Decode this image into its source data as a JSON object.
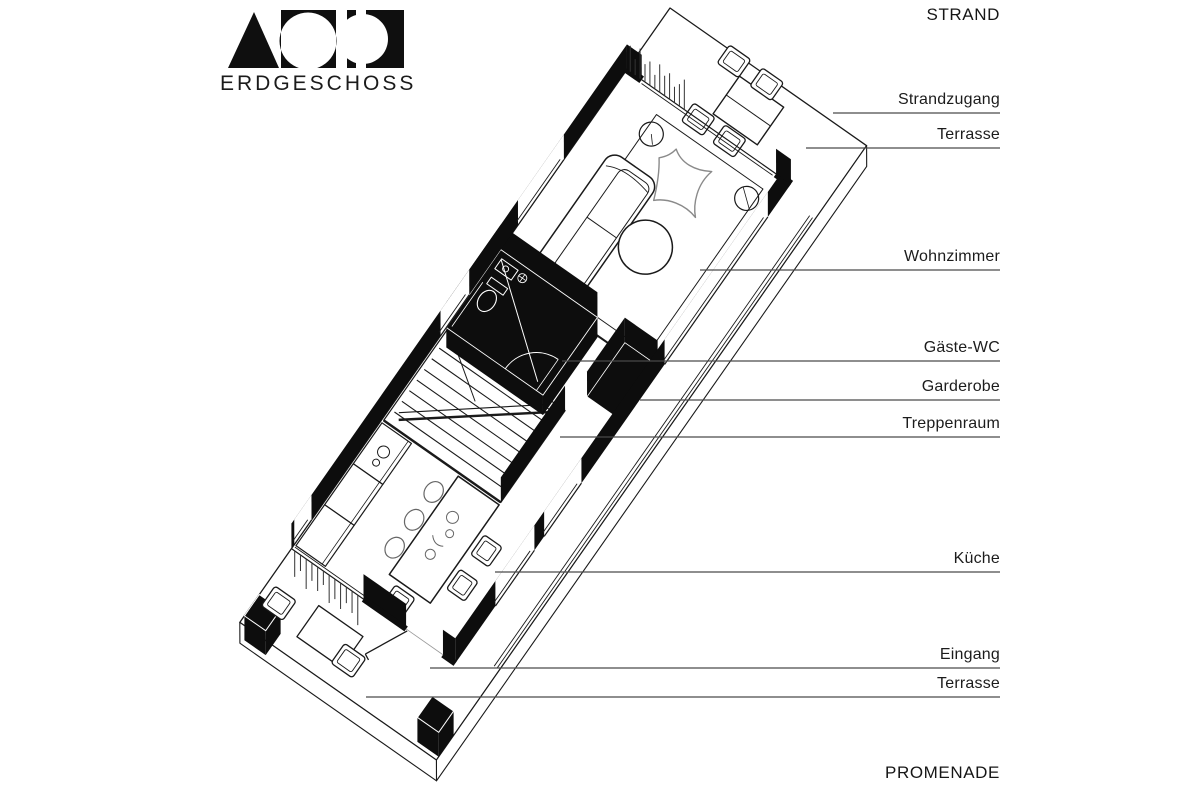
{
  "logo": {
    "brand": "VOID",
    "subtitle": "ERDGESCHOSS"
  },
  "context_labels": {
    "top": "STRAND",
    "bottom": "PROMENADE"
  },
  "annotations": [
    {
      "label": "Strandzugang",
      "y": 113,
      "x0": 833
    },
    {
      "label": "Terrasse",
      "y": 148,
      "x0": 806
    },
    {
      "label": "Wohnzimmer",
      "y": 270,
      "x0": 700
    },
    {
      "label": "Gäste-WC",
      "y": 361,
      "x0": 562
    },
    {
      "label": "Garderobe",
      "y": 400,
      "x0": 640
    },
    {
      "label": "Treppenraum",
      "y": 437,
      "x0": 560
    },
    {
      "label": "Küche",
      "y": 572,
      "x0": 495
    },
    {
      "label": "Eingang",
      "y": 668,
      "x0": 430
    },
    {
      "label": "Terrasse",
      "y": 697,
      "x0": 366
    }
  ],
  "rooms_depicted": [
    "Terrasse (Strand)",
    "Wohnzimmer",
    "Gäste-WC",
    "Garderobe",
    "Treppenraum",
    "Küche",
    "Eingang",
    "Terrasse (Promenade)"
  ],
  "colors": {
    "ink": "#1a1a1a",
    "dark_fill": "#0d0d0d",
    "sketch": "#8a8a8a",
    "leader": "#4a4a4a",
    "background": "#ffffff"
  }
}
